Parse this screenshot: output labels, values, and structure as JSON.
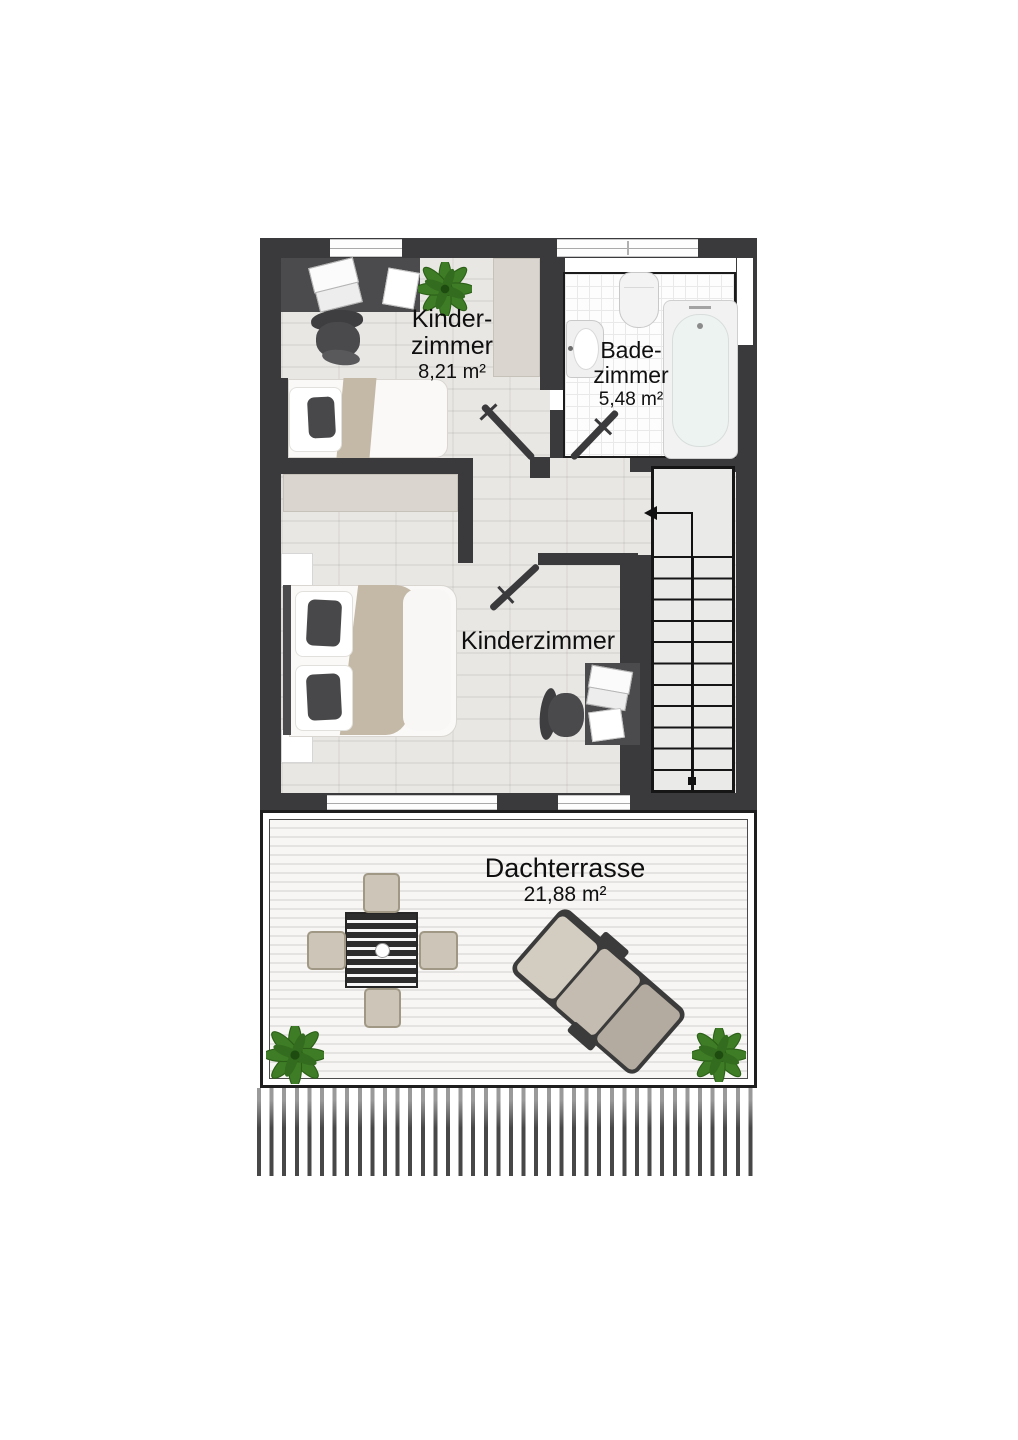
{
  "floorplan": {
    "rooms": {
      "kinderzimmer_small": {
        "label_line1": "Kinder-",
        "label_line2": "zimmer",
        "area": "8,21 m²"
      },
      "badezimmer": {
        "label_line1": "Bade-",
        "label_line2": "zimmer",
        "area": "5,48 m²"
      },
      "kinderzimmer_large": {
        "label": "Kinderzimmer"
      },
      "dachterrasse": {
        "label": "Dachterrasse",
        "area": "21,88 m²"
      }
    },
    "colors": {
      "wall": "#3a3a3c",
      "floor_wood": "#e7e5e2",
      "bathroom_tile": "#fdfdfd",
      "furniture_dark": "#4b4b4d",
      "textile_beige": "#c4b9a7",
      "plant_green": "#3e7d26",
      "stairs_fill": "#eaeae9"
    }
  }
}
